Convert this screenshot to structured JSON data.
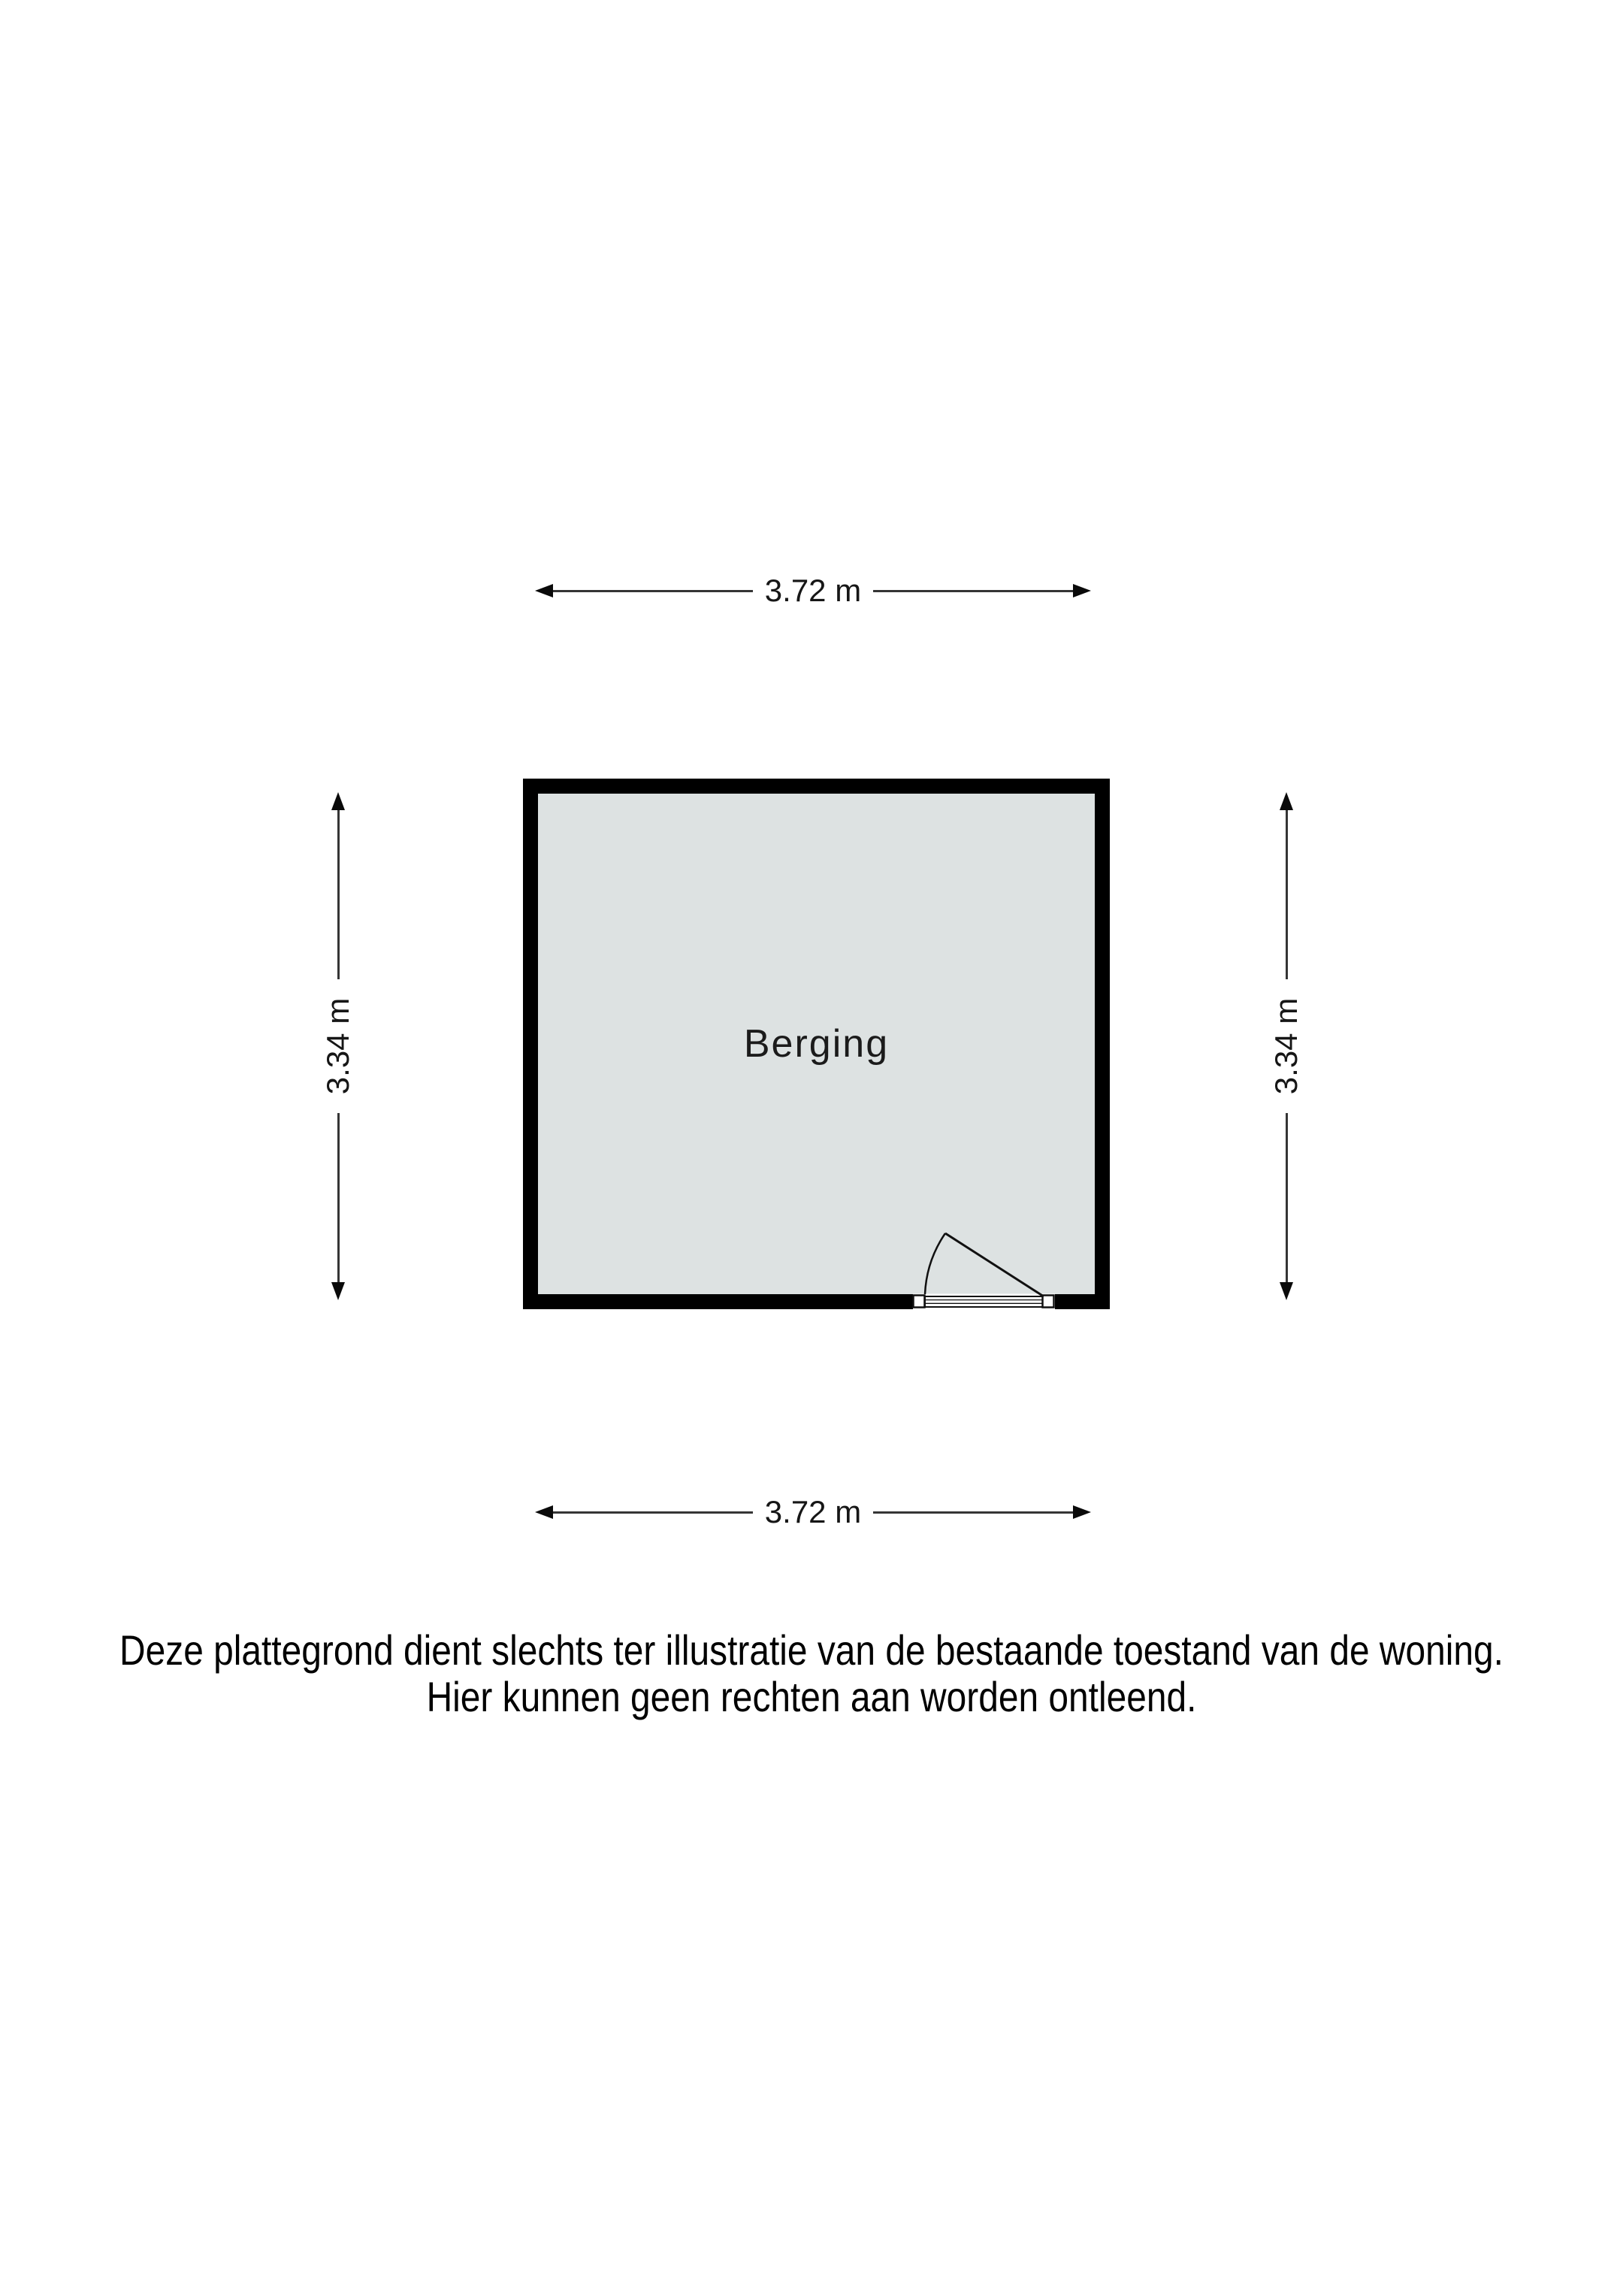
{
  "floorplan": {
    "room": {
      "label": "Berging",
      "fill_color": "#dde2e2",
      "wall_color": "#000000"
    },
    "dimensions": {
      "top": "3.72 m",
      "bottom": "3.72 m",
      "left": "3.34 m",
      "right": "3.34 m"
    }
  },
  "disclaimer": {
    "line1": "Deze plattegrond dient slechts ter illustratie van de bestaande toestand van de woning.",
    "line2": "Hier kunnen geen rechten aan worden ontleend."
  }
}
